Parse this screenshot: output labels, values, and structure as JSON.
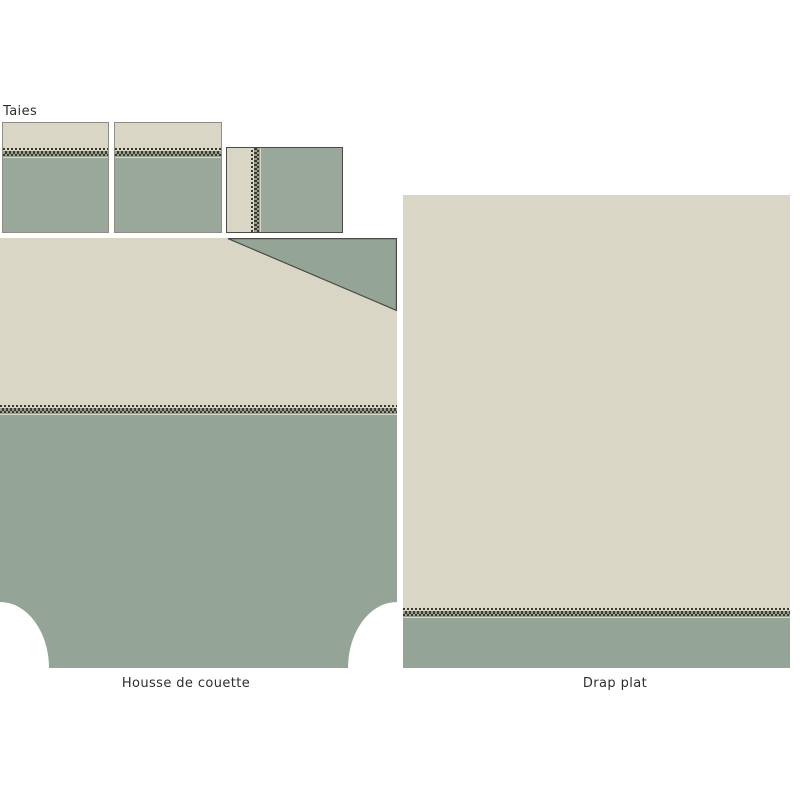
{
  "labels": {
    "pillowcases": "Taies",
    "duvet_cover": "Housse de couette",
    "flat_sheet": "Drap plat"
  },
  "pieces": [
    {
      "id": "pillowcase-1"
    },
    {
      "id": "pillowcase-2"
    },
    {
      "id": "pillowcase-3-side-view"
    },
    {
      "id": "duvet-cover",
      "features": [
        "folded-back corner",
        "rounded bottom notches",
        "stitch band"
      ]
    },
    {
      "id": "flat-sheet",
      "features": [
        "stitch band near hem"
      ]
    }
  ],
  "colors": {
    "fabric_cream": "#dad6c6",
    "fabric_green": "#94a497",
    "fabric_green_light": "#9aa89c",
    "stitch_dark": "#3a3a31",
    "stitch_mid": "#9aa091",
    "outline_light": "#8e8e86",
    "outline_dark": "#4b4b44",
    "text": "#2e2e2a",
    "background": "#ffffff"
  }
}
